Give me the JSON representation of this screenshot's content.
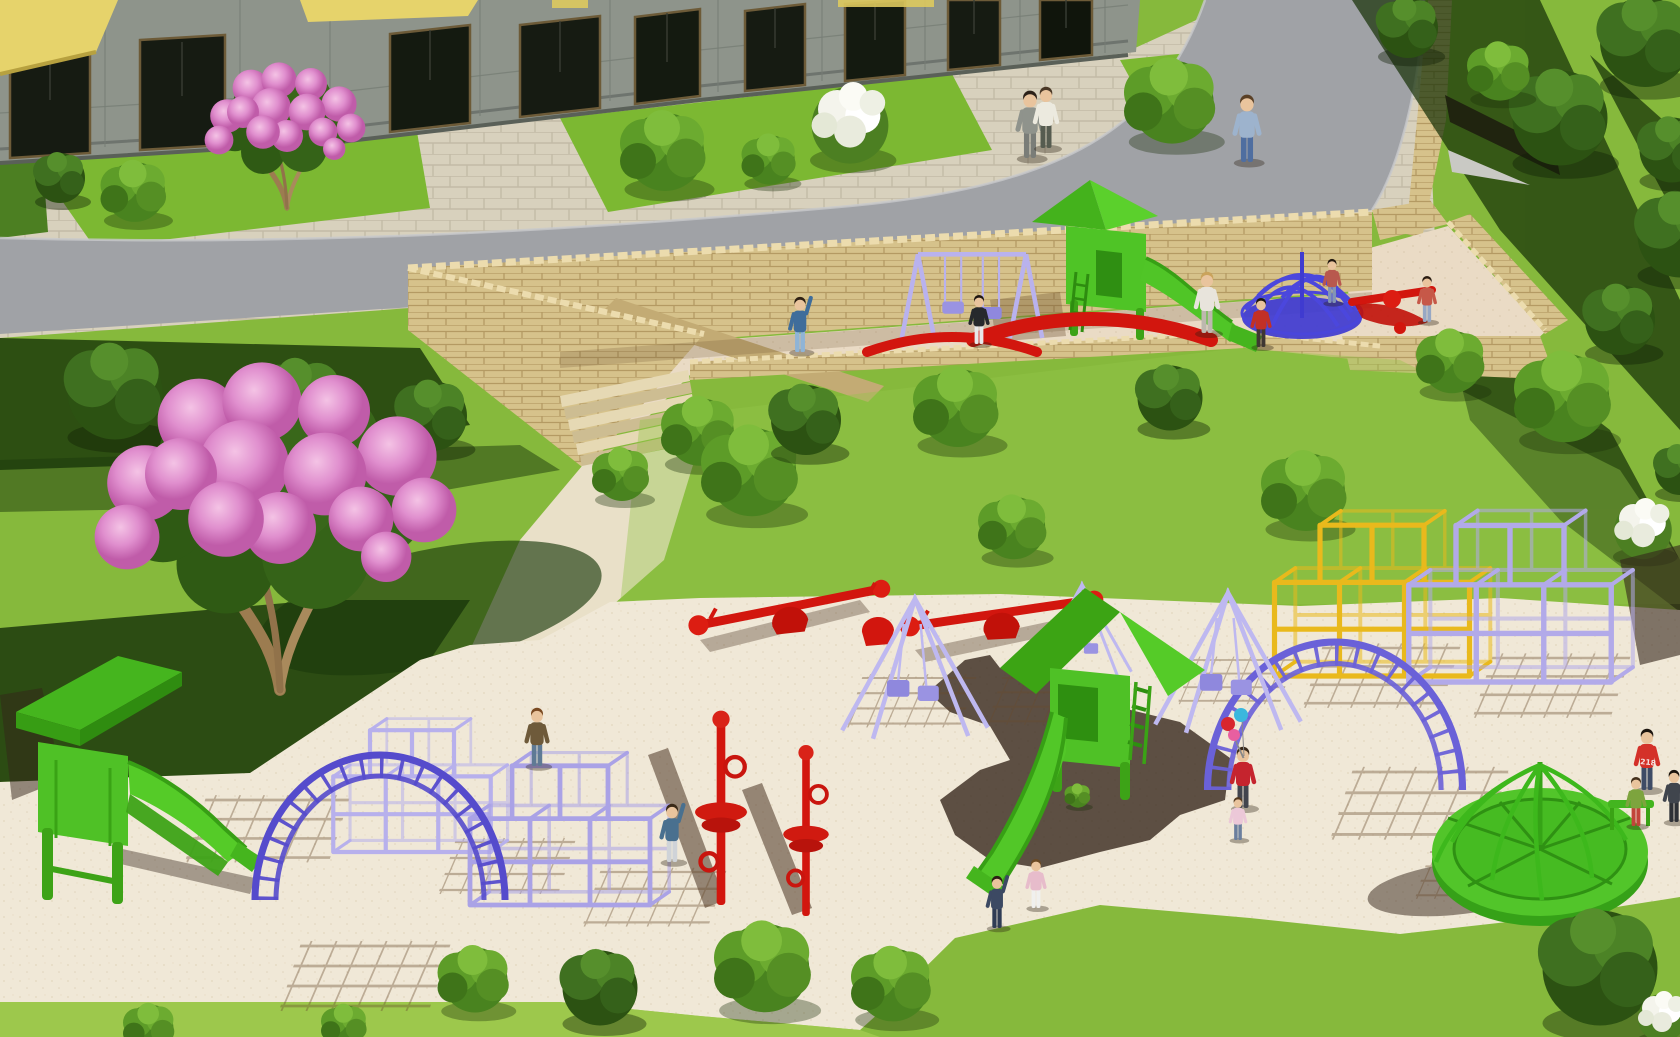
{
  "scene": {
    "description": "3D architectural rendering: residential building courtyard with curved road, stone retaining walls, sunken terrace playground and large sand playground with colorful equipment, trees and children"
  },
  "labels": {
    "hoodie_text": "218"
  },
  "palette": {
    "grass": "#86b93c",
    "grassBright": "#a4cd52",
    "lawn": "#7cb832",
    "sand": "#f0e8d7",
    "terraceSand": "#eaDBc5",
    "road": "#a0a2a6",
    "pavement": "#d8d1bd",
    "pavingLine": "#c3bba6",
    "wall": "#d6c28b",
    "wallLine": "#ab9059",
    "coping": "#ecdcae",
    "green": "#50c327",
    "greenDark": "#3aa315",
    "lavender": "#b6afec",
    "violet": "#5b51cf",
    "blue": "#403cd1",
    "red": "#d2160e",
    "yellow": "#e9b91c",
    "facade": "#8e948b",
    "awning": "#e6d36b",
    "shadow": "#33241a"
  },
  "inventory": [
    "apartment-building",
    "yellow-awnings",
    "paved-plaza",
    "lawn-patches",
    "curved-road",
    "stone-retaining-wall",
    "stone-steps",
    "upper-terrace-playground",
    "purple-swing-set",
    "green-slide-tower-upper",
    "blue-spiral-climber",
    "red-arc-seesaws",
    "pink-blossom-tree-large",
    "pink-blossom-tree-small",
    "white-flower-bushes",
    "green-bushes",
    "lower-sand-playground",
    "green-slide-tower-left",
    "green-slide-tower-center",
    "purple-cube-climbers",
    "yellow-cube-climber",
    "purple-arch-ladders",
    "red-climbing-poles",
    "red-seesaws",
    "purple-pyramid-swings",
    "green-merry-go-round",
    "children-and-adults"
  ],
  "bushes": {
    "plaza": [
      {
        "def": "bushdark",
        "x": 60,
        "y": 178,
        "s": 1.0
      },
      {
        "def": "bush",
        "x": 135,
        "y": 192,
        "s": 1.15
      },
      {
        "def": "bush",
        "x": 665,
        "y": 152,
        "s": 1.5
      },
      {
        "def": "bush",
        "x": 770,
        "y": 160,
        "s": 0.95
      },
      {
        "def": "whitebush",
        "x": 850,
        "y": 122,
        "s": 1.6
      },
      {
        "def": "bush",
        "x": 1172,
        "y": 102,
        "s": 1.6
      },
      {
        "def": "bushdark",
        "x": 1408,
        "y": 28,
        "s": 1.2
      }
    ],
    "slope": [
      {
        "def": "bushdark",
        "x": 1560,
        "y": 118,
        "s": 1.9
      },
      {
        "def": "bush",
        "x": 1500,
        "y": 72,
        "s": 1.1
      },
      {
        "def": "bushdark",
        "x": 1680,
        "y": 235,
        "s": 1.7
      },
      {
        "def": "bushdark",
        "x": 1620,
        "y": 320,
        "s": 1.4
      },
      {
        "def": "bushdark",
        "x": 1672,
        "y": 150,
        "s": 1.3
      },
      {
        "def": "bushdark",
        "x": 1645,
        "y": 42,
        "s": 1.8
      }
    ],
    "mid": [
      {
        "def": "bushdark",
        "x": 115,
        "y": 392,
        "s": 1.9
      },
      {
        "def": "bushdark",
        "x": 300,
        "y": 402,
        "s": 1.7
      },
      {
        "def": "bushdark",
        "x": 432,
        "y": 416,
        "s": 1.4
      },
      {
        "def": "bush",
        "x": 622,
        "y": 475,
        "s": 1.0
      },
      {
        "def": "bush",
        "x": 700,
        "y": 432,
        "s": 1.3
      },
      {
        "def": "bush",
        "x": 752,
        "y": 472,
        "s": 1.7
      },
      {
        "def": "bushdark",
        "x": 806,
        "y": 420,
        "s": 1.4
      },
      {
        "def": "bush",
        "x": 958,
        "y": 408,
        "s": 1.5
      },
      {
        "def": "bush",
        "x": 1014,
        "y": 528,
        "s": 1.2
      },
      {
        "def": "bushdark",
        "x": 1170,
        "y": 398,
        "s": 1.3
      },
      {
        "def": "bush",
        "x": 1306,
        "y": 492,
        "s": 1.5
      },
      {
        "def": "bush",
        "x": 1452,
        "y": 362,
        "s": 1.2
      },
      {
        "def": "bush",
        "x": 1565,
        "y": 398,
        "s": 1.7
      },
      {
        "def": "whitebush",
        "x": 1643,
        "y": 528,
        "s": 1.2
      },
      {
        "def": "bushdark",
        "x": 1680,
        "y": 470,
        "s": 1.0
      }
    ],
    "bottom": [
      {
        "def": "bush",
        "x": 150,
        "y": 1028,
        "s": 0.9
      },
      {
        "def": "bush",
        "x": 345,
        "y": 1026,
        "s": 0.8
      },
      {
        "def": "bush",
        "x": 475,
        "y": 980,
        "s": 1.25
      },
      {
        "def": "bushdark",
        "x": 600,
        "y": 988,
        "s": 1.5
      },
      {
        "def": "bush",
        "x": 765,
        "y": 968,
        "s": 1.7
      },
      {
        "def": "bush",
        "x": 893,
        "y": 985,
        "s": 1.4
      },
      {
        "def": "bush",
        "x": 1078,
        "y": 796,
        "s": 0.45
      },
      {
        "def": "bushdark",
        "x": 1600,
        "y": 968,
        "s": 2.3
      },
      {
        "def": "whitebush",
        "x": 1662,
        "y": 1016,
        "s": 1.0
      }
    ]
  },
  "equipment": {
    "cubes": [
      {
        "def": "cubes",
        "x": 412,
        "y": 852,
        "s": 1.05,
        "vars": {
          "c": "#b7b0ec"
        },
        "name": "purple-cube-climber-left-a"
      },
      {
        "def": "cubes",
        "x": 560,
        "y": 905,
        "s": 1.2,
        "vars": {
          "c": "#aaa2e6"
        },
        "name": "purple-cube-climber-left-b"
      },
      {
        "def": "cubes",
        "x": 1372,
        "y": 676,
        "s": 1.3,
        "vars": {
          "c": "#e9b91c"
        },
        "name": "yellow-cube-climber"
      },
      {
        "def": "cubes",
        "x": 1510,
        "y": 682,
        "s": 1.35,
        "vars": {
          "c": "#b2aae9"
        },
        "name": "purple-cube-climber-right"
      }
    ],
    "arches": [
      {
        "def": "arch",
        "x": 380,
        "y": 900,
        "s": 1.0,
        "vars": {
          "c": "#554bcc"
        },
        "name": "purple-arch-ladder-left"
      },
      {
        "def": "arch",
        "x": 1335,
        "y": 790,
        "s": 1.02,
        "vars": {
          "c": "#6a61d8"
        },
        "name": "purple-arch-ladder-right"
      }
    ],
    "pyramids": [
      {
        "def": "pyramid",
        "x": 915,
        "y": 722,
        "s": 1.4,
        "vars": {
          "c": "#beb8f0"
        },
        "name": "purple-pyramid-swing-1"
      },
      {
        "def": "pyramid",
        "x": 1082,
        "y": 668,
        "s": 0.95,
        "vars": {
          "c": "#beb8f0"
        },
        "name": "purple-pyramid-swing-2"
      },
      {
        "def": "pyramid",
        "x": 1228,
        "y": 716,
        "s": 1.4,
        "vars": {
          "c": "#beb8f0"
        },
        "name": "purple-pyramid-swing-3"
      }
    ],
    "swings": [
      {
        "def": "pswing",
        "x": 972,
        "y": 338,
        "s": 1.35,
        "vars": {
          "c": "#b9b2ee"
        },
        "name": "purple-swing-set-terrace"
      }
    ],
    "poles": [
      {
        "def": "redpole",
        "x": 721,
        "y": 905,
        "s": 1.08,
        "name": "red-climbing-pole-1"
      },
      {
        "def": "redpole",
        "x": 806,
        "y": 916,
        "s": 0.95,
        "name": "red-climbing-pole-2"
      }
    ],
    "seesaws": [
      {
        "def": "seesaw",
        "x": 790,
        "y": 612,
        "s": 1.0,
        "r": -2,
        "name": "red-seesaw-1"
      },
      {
        "def": "seesaw",
        "x": 1002,
        "y": 618,
        "s": 1.0,
        "r": 1,
        "name": "red-seesaw-2"
      }
    ],
    "redarcs": [
      {
        "def": "redarc",
        "x": 952,
        "y": 352,
        "s": 1.0,
        "name": "red-arc-terrace-1"
      },
      {
        "def": "redarc",
        "x": 1092,
        "y": 340,
        "s": 1.4,
        "name": "red-arc-terrace-2"
      }
    ],
    "grids": [
      {
        "def": "gridshadow",
        "x": 205,
        "y": 800,
        "s": 1.2
      },
      {
        "def": "gridshadow",
        "x": 455,
        "y": 842,
        "s": 1.0
      },
      {
        "def": "gridshadow",
        "x": 600,
        "y": 872,
        "s": 1.05
      },
      {
        "def": "gridshadow",
        "x": 862,
        "y": 678,
        "s": 0.95
      },
      {
        "def": "gridshadow",
        "x": 1002,
        "y": 678,
        "s": 0.9
      },
      {
        "def": "gridshadow",
        "x": 1192,
        "y": 660,
        "s": 0.85
      },
      {
        "def": "gridshadow",
        "x": 1322,
        "y": 648,
        "s": 1.15
      },
      {
        "def": "gridshadow",
        "x": 1492,
        "y": 658,
        "s": 1.15
      },
      {
        "def": "gridshadow",
        "x": 300,
        "y": 946,
        "s": 1.25
      },
      {
        "def": "gridshadow",
        "x": 1352,
        "y": 772,
        "s": 1.3
      },
      {
        "def": "gridshadow",
        "x": 1430,
        "y": 852,
        "s": 0.9
      }
    ]
  },
  "trees": {
    "pink": [
      {
        "def": "pinktree",
        "x": 280,
        "y": 690,
        "s": 0.9,
        "name": "pink-blossom-tree-large"
      },
      {
        "def": "pinktree",
        "x": 287,
        "y": 208,
        "s": 0.4,
        "name": "pink-blossom-tree-small"
      }
    ]
  },
  "people": [
    {
      "def": "person",
      "x": 1030,
      "y": 158,
      "s": 1.1,
      "vars": {
        "shirt": "#8f938c",
        "pants": "#7a7d78",
        "hair": "#2c2118"
      },
      "name": "man-gray-suit"
    },
    {
      "def": "person",
      "x": 1046,
      "y": 148,
      "s": 1.0,
      "vars": {
        "shirt": "#eceadf",
        "pants": "#565c50",
        "hair": "#4a3826"
      },
      "name": "man-white-shirt"
    },
    {
      "def": "person",
      "x": 1247,
      "y": 162,
      "s": 1.1,
      "vars": {
        "shirt": "#9db3cd",
        "pants": "#4f6ea0",
        "hair": "#5a4026"
      },
      "name": "man-plaid-shirt"
    },
    {
      "def": "person-wave",
      "x": 800,
      "y": 352,
      "s": 0.9,
      "vars": {
        "shirt": "#3f6d9b",
        "pants": "#8fb4d6",
        "hair": "#2e2013"
      },
      "name": "boy-terrace"
    },
    {
      "def": "person",
      "x": 979,
      "y": 344,
      "s": 0.8,
      "vars": {
        "shirt": "#26292c",
        "pants": "#e8e9ea",
        "hair": "#1e1610"
      },
      "name": "boy-at-swing"
    },
    {
      "def": "person",
      "x": 1207,
      "y": 333,
      "s": 1.0,
      "vars": {
        "shirt": "#e8e4dc",
        "pants": "#bdb8ae",
        "hair": "#caa35c"
      },
      "name": "woman-terrace"
    },
    {
      "def": "person",
      "x": 1261,
      "y": 347,
      "s": 0.8,
      "vars": {
        "shirt": "#c23026",
        "pants": "#3f3733",
        "hair": "#1f1812"
      },
      "name": "kid-red-terrace"
    },
    {
      "def": "person",
      "x": 1332,
      "y": 303,
      "s": 0.72,
      "vars": {
        "shirt": "#b8584e",
        "pants": "#8395b5",
        "hair": "#241a10"
      },
      "name": "kid-at-spiral"
    },
    {
      "def": "person",
      "x": 1427,
      "y": 322,
      "s": 0.75,
      "vars": {
        "shirt": "#c65848",
        "pants": "#97a8c4",
        "hair": "#2a1d12"
      },
      "name": "kid-sandbox"
    },
    {
      "def": "person",
      "x": 537,
      "y": 766,
      "s": 0.95,
      "vars": {
        "shirt": "#6e5a3a",
        "pants": "#5f7a95",
        "hair": "#7a4a22"
      },
      "name": "boy-running"
    },
    {
      "def": "person-wave",
      "x": 672,
      "y": 862,
      "s": 0.95,
      "vars": {
        "shirt": "#49708f",
        "pants": "#cfd3d8",
        "hair": "#3a2a18"
      },
      "name": "boy-waving"
    },
    {
      "def": "person-wave",
      "x": 997,
      "y": 928,
      "s": 0.85,
      "vars": {
        "shirt": "#3c4963",
        "pants": "#303c55",
        "hair": "#2c2014"
      },
      "name": "boy-slide-bottom"
    },
    {
      "def": "person",
      "x": 1036,
      "y": 908,
      "s": 0.8,
      "vars": {
        "shirt": "#e7bccb",
        "pants": "#f0f0ee",
        "hair": "#6b4a24"
      },
      "name": "girl-pink"
    },
    {
      "def": "person",
      "x": 1243,
      "y": 808,
      "s": 1.0,
      "vars": {
        "shirt": "#c5242e",
        "pants": "#42454e",
        "hair": "#3a2a1a"
      },
      "name": "woman-balloons"
    },
    {
      "def": "person",
      "x": 1238,
      "y": 840,
      "s": 0.7,
      "vars": {
        "shirt": "#ecc8d8",
        "pants": "#6b7f9e",
        "hair": "#54391e"
      },
      "name": "toddler-pink"
    },
    {
      "def": "person",
      "x": 1647,
      "y": 790,
      "s": 1.0,
      "vars": {
        "shirt": "#d43129",
        "pants": "#3e4c66",
        "hair": "#1d150e"
      },
      "name": "boy-hoodie-218"
    },
    {
      "def": "person",
      "x": 1636,
      "y": 826,
      "s": 0.8,
      "vars": {
        "shirt": "#7da43e",
        "pants": "#c2443a",
        "hair": "#43301c"
      },
      "name": "kid-green-shirt"
    },
    {
      "def": "person",
      "x": 1674,
      "y": 822,
      "s": 0.85,
      "vars": {
        "shirt": "#40454d",
        "pants": "#2e3136",
        "hair": "#1b140d"
      },
      "name": "kid-right-edge"
    }
  ]
}
